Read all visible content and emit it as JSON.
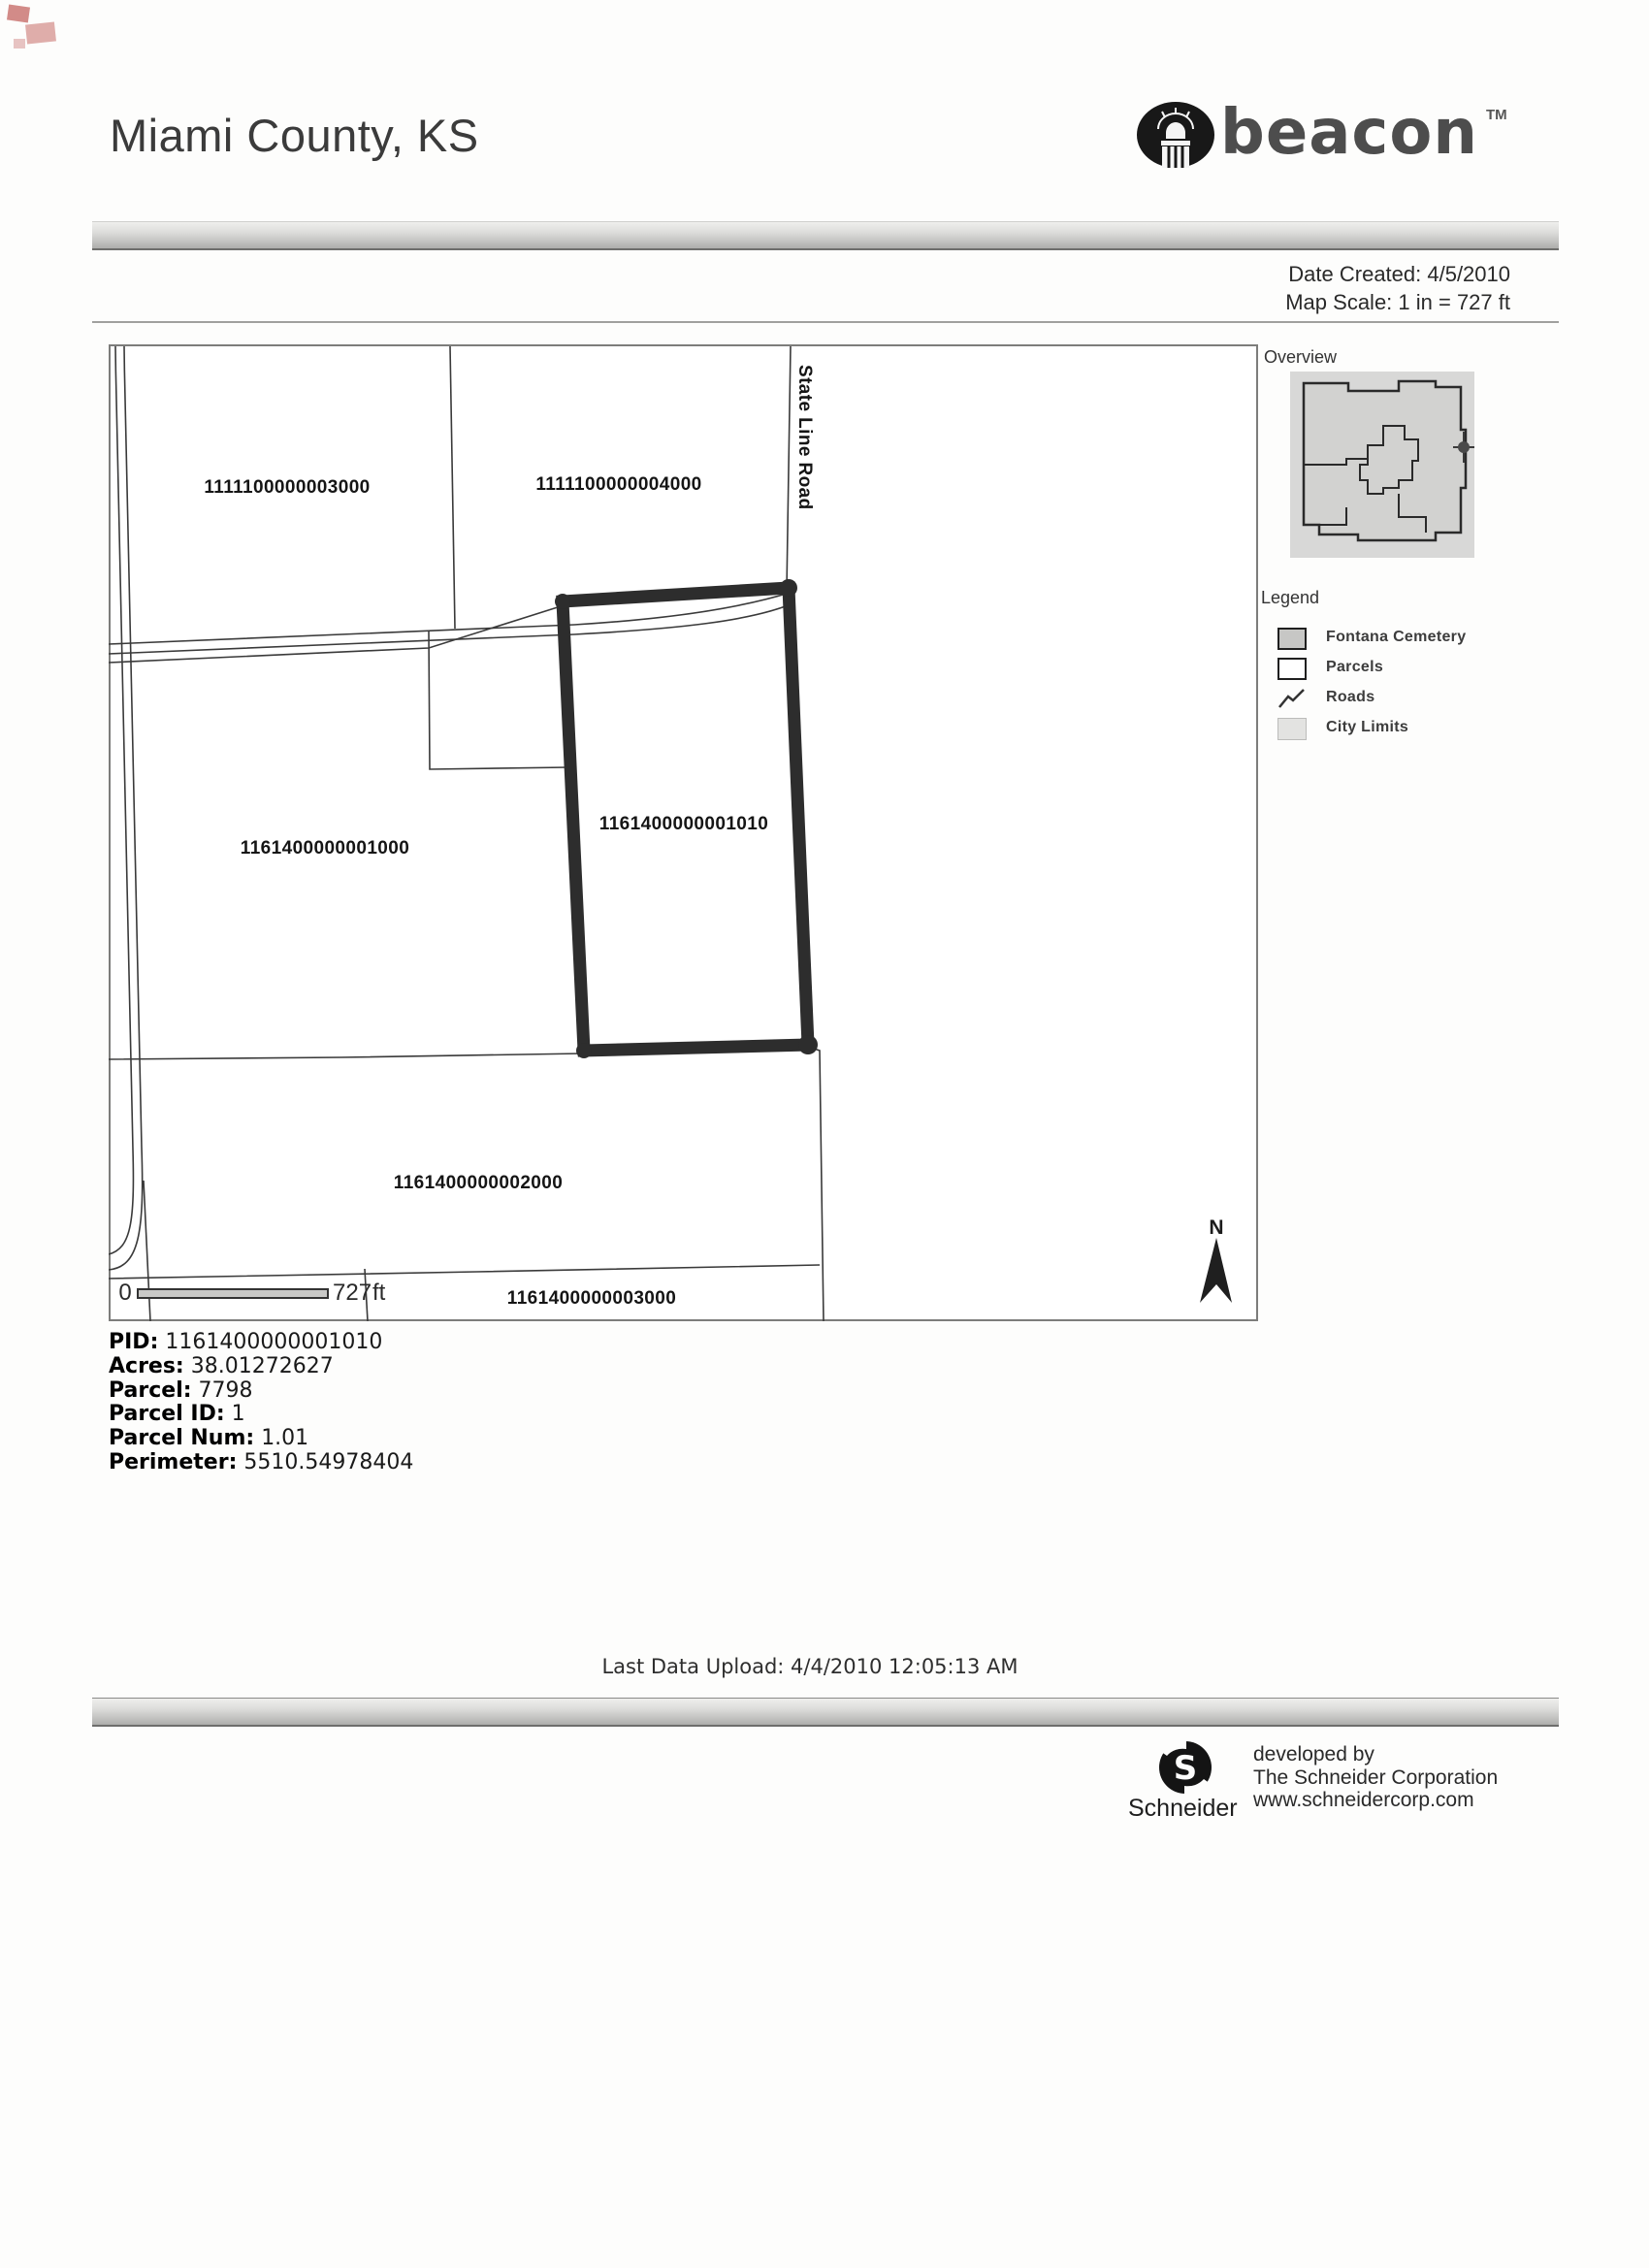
{
  "header": {
    "title": "Miami County, KS",
    "brand": {
      "name": "beacon",
      "tm": "TM",
      "icon": "capitol-dome-icon"
    }
  },
  "meta": {
    "date_created": "Date Created: 4/5/2010",
    "map_scale": "Map Scale: 1 in = 727 ft"
  },
  "map": {
    "road_label": "State Line Road",
    "north_label": "N",
    "scalebar": {
      "zero": "0",
      "distance": "727",
      "unit": "ft"
    },
    "parcels": [
      {
        "id": "1111100000003000"
      },
      {
        "id": "1111100000004000"
      },
      {
        "id": "1161400000001000"
      },
      {
        "id": "1161400000001010",
        "highlighted": true
      },
      {
        "id": "1161400000002000"
      },
      {
        "id": "1161400000003000"
      }
    ],
    "highlight_outline_color": "#2d2d2d"
  },
  "overview": {
    "title": "Overview"
  },
  "legend": {
    "title": "Legend",
    "items": [
      {
        "label": "Fontana Cemetery",
        "swatch": "gray-fill"
      },
      {
        "label": "Parcels",
        "swatch": "white-fill"
      },
      {
        "label": "Roads",
        "swatch": "zigzag-line"
      },
      {
        "label": "City Limits",
        "swatch": "light-gray-fill"
      }
    ]
  },
  "parcel_info": {
    "rows": [
      {
        "label": "PID:",
        "value": "1161400000001010"
      },
      {
        "label": "Acres:",
        "value": "38.01272627"
      },
      {
        "label": "Parcel:",
        "value": "7798"
      },
      {
        "label": "Parcel ID:",
        "value": "1"
      },
      {
        "label": "Parcel Num:",
        "value": "1.01"
      },
      {
        "label": "Perimeter:",
        "value": "5510.54978404"
      }
    ]
  },
  "footer": {
    "last_upload": "Last Data Upload: 4/4/2010 12:05:13 AM",
    "developer": {
      "brand": "Schneider",
      "line1": "developed by",
      "line2": "The Schneider Corporation",
      "line3": "www.schneidercorp.com"
    }
  }
}
